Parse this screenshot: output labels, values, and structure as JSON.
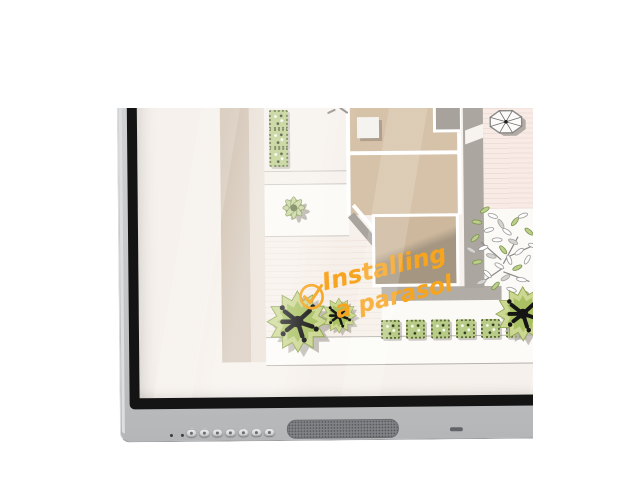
{
  "annotation": {
    "line1": "Installing",
    "line2": "a parasol",
    "icon": "checkmark-circle-icon",
    "ink_color": "#f7a41f"
  },
  "screen_plan": {
    "elements": [
      "building-footprint",
      "skylight",
      "gray-porch",
      "patio-panel",
      "starburst-plant",
      "hedge-squares",
      "boxwood-hedge-row",
      "parasol-top-view",
      "tree-canopy",
      "spiky-shrubs",
      "walkway",
      "fence-band",
      "garden-wall",
      "decking-stripes"
    ]
  },
  "device": {
    "type": "interactive-flat-panel-corner",
    "bezel_color": "#c6c8ca",
    "inner_bezel_color": "#141414",
    "indicator_dots": 2,
    "control_buttons": 7,
    "has_speaker_grille": true
  },
  "palette": {
    "photo_background": "#ffffff",
    "screen_background": "#f6f1ec",
    "building_tan": "#d6c2a8",
    "wall_gray": "#aba69f",
    "foliage_green": "#b9cc87",
    "shrub_green": "#ccd792",
    "ground_pink": "#f8ebe6",
    "annotation_orange": "#f7a41f"
  }
}
